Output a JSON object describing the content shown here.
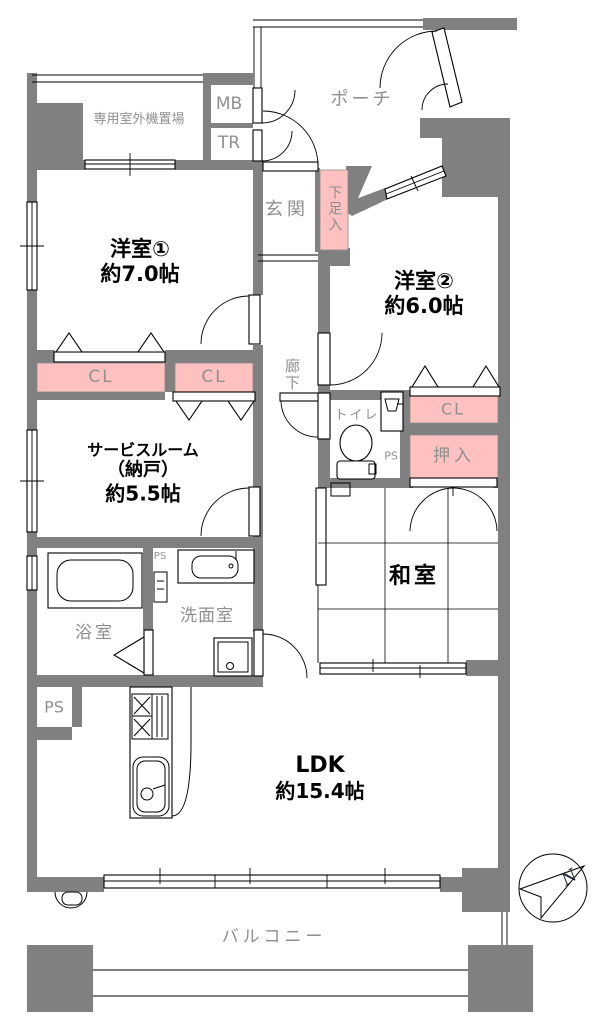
{
  "colors": {
    "wall": "#808080",
    "closet": "#ffc0c0",
    "gray_text": "#8f8f8f",
    "black_text": "#000000"
  },
  "labels": {
    "outdoor_unit": "専用室外機置場",
    "mb": "MB",
    "tr": "TR",
    "porch": "ポーチ",
    "genkan": "玄関",
    "shoe_box": "下足入",
    "room1_name": "洋室①",
    "room1_size": "約7.0帖",
    "room2_name": "洋室②",
    "room2_size": "約6.0帖",
    "cl": "CL",
    "corridor": "廊下",
    "toilet": "トイレ",
    "ps": "PS",
    "oshiire": "押入",
    "service_name": "サービスルーム",
    "service_sub": "（納戸）",
    "service_size": "約5.5帖",
    "washitsu": "和室",
    "bath": "浴室",
    "washroom": "洗面室",
    "ldk_name": "LDK",
    "ldk_size": "約15.4帖",
    "balcony": "バルコニー",
    "north": "N"
  }
}
